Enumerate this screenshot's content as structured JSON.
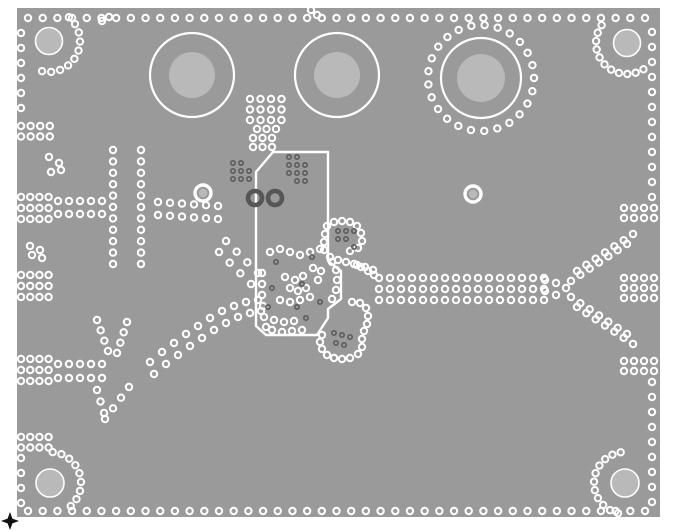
{
  "pcb": {
    "colors": {
      "background": "#ffffff",
      "board_copper": "#9a9a9a",
      "hole_disc": "#b9b9b9",
      "via_ring": "#ffffff",
      "dark_via": "#5c5c5c",
      "dark_donut": "#565656",
      "outline": "#ffffff",
      "fiducial": "#111111"
    },
    "board": {
      "x": 17,
      "y": 8,
      "w": 643,
      "h": 509
    },
    "fiducial": {
      "cx": 10,
      "cy": 521
    },
    "connectors": [
      {
        "cx": 192,
        "cy": 75,
        "r_outer": 42,
        "r_inner": 23
      },
      {
        "cx": 337,
        "cy": 75,
        "r_outer": 42,
        "r_inner": 23
      },
      {
        "cx": 481,
        "cy": 78,
        "r_outer": 40,
        "r_inner": 24
      }
    ],
    "corner_holes": [
      {
        "cx": 49,
        "cy": 41,
        "r": 13.5
      },
      {
        "cx": 627,
        "cy": 43,
        "r": 13.5
      },
      {
        "cx": 50,
        "cy": 483,
        "r": 14
      },
      {
        "cx": 625,
        "cy": 483,
        "r": 14
      }
    ],
    "light_pads": [
      {
        "cx": 203,
        "cy": 193
      },
      {
        "cx": 473,
        "cy": 194
      }
    ],
    "dark_donuts": [
      {
        "cx": 255,
        "cy": 198
      },
      {
        "cx": 275,
        "cy": 198
      }
    ],
    "outlines": [
      "M273,152 L328,152 L328,261 L341,271 L341,299 L328,309 L328,318 L317,335 L266,335 L256,326 L256,172 Z"
    ],
    "via_rows": [
      {
        "x1": 28,
        "y1": 18,
        "x2": 645,
        "y2": 18,
        "n": 43
      },
      {
        "x1": 28,
        "y1": 511,
        "x2": 645,
        "y2": 511,
        "n": 43
      },
      {
        "x1": 21,
        "y1": 33,
        "x2": 21,
        "y2": 108,
        "n": 6
      },
      {
        "x1": 21,
        "y1": 458,
        "x2": 21,
        "y2": 503,
        "n": 4
      },
      {
        "x1": 652,
        "y1": 32,
        "x2": 652,
        "y2": 197,
        "n": 12
      },
      {
        "x1": 652,
        "y1": 382,
        "x2": 652,
        "y2": 502,
        "n": 9
      },
      {
        "x1": 58,
        "y1": 201,
        "x2": 102,
        "y2": 201,
        "n": 5
      },
      {
        "x1": 58,
        "y1": 214,
        "x2": 102,
        "y2": 214,
        "n": 5
      },
      {
        "x1": 113,
        "y1": 150,
        "x2": 113,
        "y2": 264,
        "n": 11
      },
      {
        "x1": 141,
        "y1": 150,
        "x2": 141,
        "y2": 264,
        "n": 11
      },
      {
        "x1": 158,
        "y1": 202,
        "x2": 218,
        "y2": 206,
        "n": 6
      },
      {
        "x1": 158,
        "y1": 215,
        "x2": 218,
        "y2": 219,
        "n": 6
      },
      {
        "x1": 226,
        "y1": 241,
        "x2": 258,
        "y2": 273,
        "n": 4
      },
      {
        "x1": 219,
        "y1": 252,
        "x2": 251,
        "y2": 284,
        "n": 4
      },
      {
        "x1": 58,
        "y1": 364,
        "x2": 102,
        "y2": 364,
        "n": 5
      },
      {
        "x1": 58,
        "y1": 378,
        "x2": 102,
        "y2": 378,
        "n": 5
      },
      {
        "x1": 97,
        "y1": 320,
        "x2": 108,
        "y2": 351,
        "n": 4
      },
      {
        "x1": 127,
        "y1": 322,
        "x2": 117,
        "y2": 353,
        "n": 4
      },
      {
        "x1": 129,
        "y1": 387,
        "x2": 105,
        "y2": 419,
        "n": 4
      },
      {
        "x1": 97,
        "y1": 390,
        "x2": 104,
        "y2": 413,
        "n": 3
      },
      {
        "x1": 379,
        "y1": 278,
        "x2": 544,
        "y2": 278,
        "n": 16
      },
      {
        "x1": 379,
        "y1": 289,
        "x2": 544,
        "y2": 289,
        "n": 16
      },
      {
        "x1": 379,
        "y1": 300,
        "x2": 544,
        "y2": 300,
        "n": 16
      },
      {
        "x1": 571,
        "y1": 281,
        "x2": 627,
        "y2": 244,
        "n": 7
      },
      {
        "x1": 577,
        "y1": 271,
        "x2": 633,
        "y2": 234,
        "n": 7
      },
      {
        "x1": 571,
        "y1": 297,
        "x2": 627,
        "y2": 334,
        "n": 7
      },
      {
        "x1": 577,
        "y1": 307,
        "x2": 633,
        "y2": 344,
        "n": 7
      }
    ],
    "via_grids": [
      {
        "x": 21,
        "y": 126,
        "cols": 4,
        "rows": 2,
        "dx": 9.6,
        "dy": 10.5
      },
      {
        "x": 21,
        "y": 197,
        "cols": 4,
        "rows": 3,
        "dx": 9.2,
        "dy": 11
      },
      {
        "x": 21,
        "y": 275,
        "cols": 4,
        "rows": 3,
        "dx": 9.2,
        "dy": 11
      },
      {
        "x": 21,
        "y": 359,
        "cols": 4,
        "rows": 3,
        "dx": 9.2,
        "dy": 11
      },
      {
        "x": 21,
        "y": 437,
        "cols": 4,
        "rows": 2,
        "dx": 9.2,
        "dy": 10.5
      },
      {
        "x": 624,
        "y": 208,
        "cols": 4,
        "rows": 2,
        "dx": 10,
        "dy": 10
      },
      {
        "x": 624,
        "y": 278,
        "cols": 4,
        "rows": 3,
        "dx": 10,
        "dy": 10
      },
      {
        "x": 624,
        "y": 361,
        "cols": 4,
        "rows": 2,
        "dx": 10,
        "dy": 10
      },
      {
        "x": 250,
        "y": 99,
        "cols": 4,
        "rows": 3,
        "dx": 10.5,
        "dy": 10.5
      },
      {
        "x": 257,
        "y": 129,
        "cols": 3,
        "rows": 1,
        "dx": 9.5,
        "dy": 0
      },
      {
        "x": 253,
        "y": 138,
        "cols": 3,
        "rows": 1,
        "dx": 9.5,
        "dy": 0
      },
      {
        "x": 253,
        "y": 147,
        "cols": 3,
        "rows": 1,
        "dx": 9.5,
        "dy": 0
      }
    ],
    "via_arcs": [
      {
        "cx": 49,
        "cy": 41,
        "r": 31,
        "a1": -50,
        "a2": 103,
        "n": 10
      },
      {
        "cx": 627,
        "cy": 43,
        "r": 31,
        "a1": 58,
        "a2": 215,
        "n": 11
      },
      {
        "cx": 50,
        "cy": 483,
        "r": 31,
        "a1": -85,
        "a2": 48,
        "n": 9
      },
      {
        "cx": 625,
        "cy": 483,
        "r": 31,
        "a1": 103,
        "a2": 262,
        "n": 11
      },
      {
        "cx": 481,
        "cy": 78,
        "r": 53,
        "a1": 0,
        "a2": 346,
        "n": 25
      }
    ],
    "via_chains": [
      {
        "points": [
          [
            150,
            362
          ],
          [
            162,
            352
          ],
          [
            174,
            343
          ],
          [
            186,
            334
          ],
          [
            198,
            326
          ],
          [
            210,
            318
          ],
          [
            222,
            311
          ],
          [
            234,
            306
          ],
          [
            246,
            302
          ],
          [
            258,
            300
          ]
        ]
      },
      {
        "points": [
          [
            154,
            374
          ],
          [
            166,
            364
          ],
          [
            178,
            355
          ],
          [
            190,
            346
          ],
          [
            202,
            338
          ],
          [
            214,
            330
          ],
          [
            226,
            323
          ],
          [
            238,
            317
          ],
          [
            250,
            313
          ],
          [
            261,
            311
          ]
        ]
      },
      {
        "points": [
          [
            327,
            226
          ],
          [
            334,
            222
          ],
          [
            342,
            221
          ],
          [
            350,
            222
          ],
          [
            357,
            226
          ],
          [
            361,
            233
          ],
          [
            362,
            241
          ],
          [
            358,
            248
          ],
          [
            350,
            251
          ],
          [
            325,
            234
          ],
          [
            324,
            242
          ],
          [
            324,
            250
          ]
        ]
      },
      {
        "points": [
          [
            330,
            257
          ],
          [
            338,
            260
          ],
          [
            346,
            262
          ],
          [
            354,
            264
          ],
          [
            361,
            267
          ],
          [
            368,
            271
          ],
          [
            374,
            275
          ]
        ]
      },
      {
        "points": [
          [
            352,
            302
          ],
          [
            360,
            303
          ],
          [
            366,
            308
          ],
          [
            368,
            316
          ],
          [
            367,
            324
          ],
          [
            364,
            331
          ],
          [
            362,
            339
          ],
          [
            362,
            347
          ],
          [
            358,
            354
          ],
          [
            350,
            358
          ],
          [
            342,
            359
          ],
          [
            334,
            358
          ],
          [
            327,
            355
          ],
          [
            322,
            349
          ],
          [
            320,
            342
          ],
          [
            322,
            335
          ]
        ]
      },
      {
        "points": [
          [
            49,
            157
          ],
          [
            59,
            163
          ],
          [
            51,
            172
          ],
          [
            61,
            170
          ]
        ]
      },
      {
        "points": [
          [
            30,
            246
          ],
          [
            40,
            250
          ],
          [
            32,
            255
          ],
          [
            42,
            258
          ]
        ]
      },
      {
        "points": [
          [
            262,
            273
          ],
          [
            262,
            284
          ],
          [
            262,
            295
          ],
          [
            263,
            306
          ],
          [
            264,
            317
          ],
          [
            266,
            327
          ]
        ]
      },
      {
        "points": [
          [
            272,
            330
          ],
          [
            282,
            332
          ],
          [
            292,
            331
          ],
          [
            302,
            330
          ],
          [
            274,
            320
          ],
          [
            284,
            322
          ],
          [
            294,
            321
          ]
        ]
      },
      {
        "points": [
          [
            285,
            277
          ],
          [
            295,
            280
          ],
          [
            303,
            276
          ],
          [
            290,
            288
          ],
          [
            298,
            291
          ],
          [
            306,
            288
          ],
          [
            280,
            300
          ],
          [
            290,
            302
          ],
          [
            300,
            300
          ],
          [
            310,
            297
          ]
        ]
      },
      {
        "points": [
          [
            270,
            252
          ],
          [
            280,
            249
          ],
          [
            290,
            252
          ],
          [
            300,
            255
          ],
          [
            310,
            252
          ],
          [
            320,
            249
          ],
          [
            313,
            268
          ],
          [
            321,
            271
          ],
          [
            318,
            280
          ]
        ]
      },
      {
        "points": [
          [
            332,
            262
          ],
          [
            336,
            270
          ],
          [
            337,
            280
          ],
          [
            336,
            290
          ],
          [
            332,
            299
          ]
        ]
      },
      {
        "points": [
          [
            357,
            265
          ],
          [
            365,
            267
          ],
          [
            373,
            270
          ]
        ]
      },
      {
        "points": [
          [
            311,
            10
          ],
          [
            317,
            15
          ],
          [
            102,
            21
          ],
          [
            109,
            17
          ]
        ]
      },
      {
        "points": [
          [
            545,
            280
          ],
          [
            545,
            291
          ],
          [
            556,
            283
          ],
          [
            556,
            295
          ],
          [
            566,
            288
          ]
        ]
      }
    ],
    "dark_vias": [
      [
        233,
        163
      ],
      [
        241,
        163
      ],
      [
        233,
        171
      ],
      [
        241,
        171
      ],
      [
        249,
        171
      ],
      [
        233,
        179
      ],
      [
        241,
        179
      ],
      [
        249,
        179
      ],
      [
        289,
        157
      ],
      [
        297,
        157
      ],
      [
        289,
        165
      ],
      [
        297,
        165
      ],
      [
        305,
        165
      ],
      [
        289,
        173
      ],
      [
        297,
        173
      ],
      [
        305,
        173
      ],
      [
        297,
        181
      ],
      [
        305,
        181
      ],
      [
        338,
        231
      ],
      [
        346,
        231
      ],
      [
        354,
        231
      ],
      [
        338,
        239
      ],
      [
        346,
        239
      ],
      [
        354,
        247
      ],
      [
        334,
        333
      ],
      [
        342,
        335
      ],
      [
        350,
        337
      ],
      [
        336,
        343
      ],
      [
        344,
        345
      ],
      [
        272,
        288
      ],
      [
        302,
        284
      ],
      [
        268,
        307
      ],
      [
        297,
        307
      ],
      [
        306,
        318
      ],
      [
        312,
        257
      ],
      [
        320,
        302
      ],
      [
        276,
        262
      ]
    ],
    "via_style": {
      "r": 3.2,
      "stroke_width": 2.0
    },
    "dark_style": {
      "r": 2.2,
      "stroke_width": 1.6
    }
  }
}
